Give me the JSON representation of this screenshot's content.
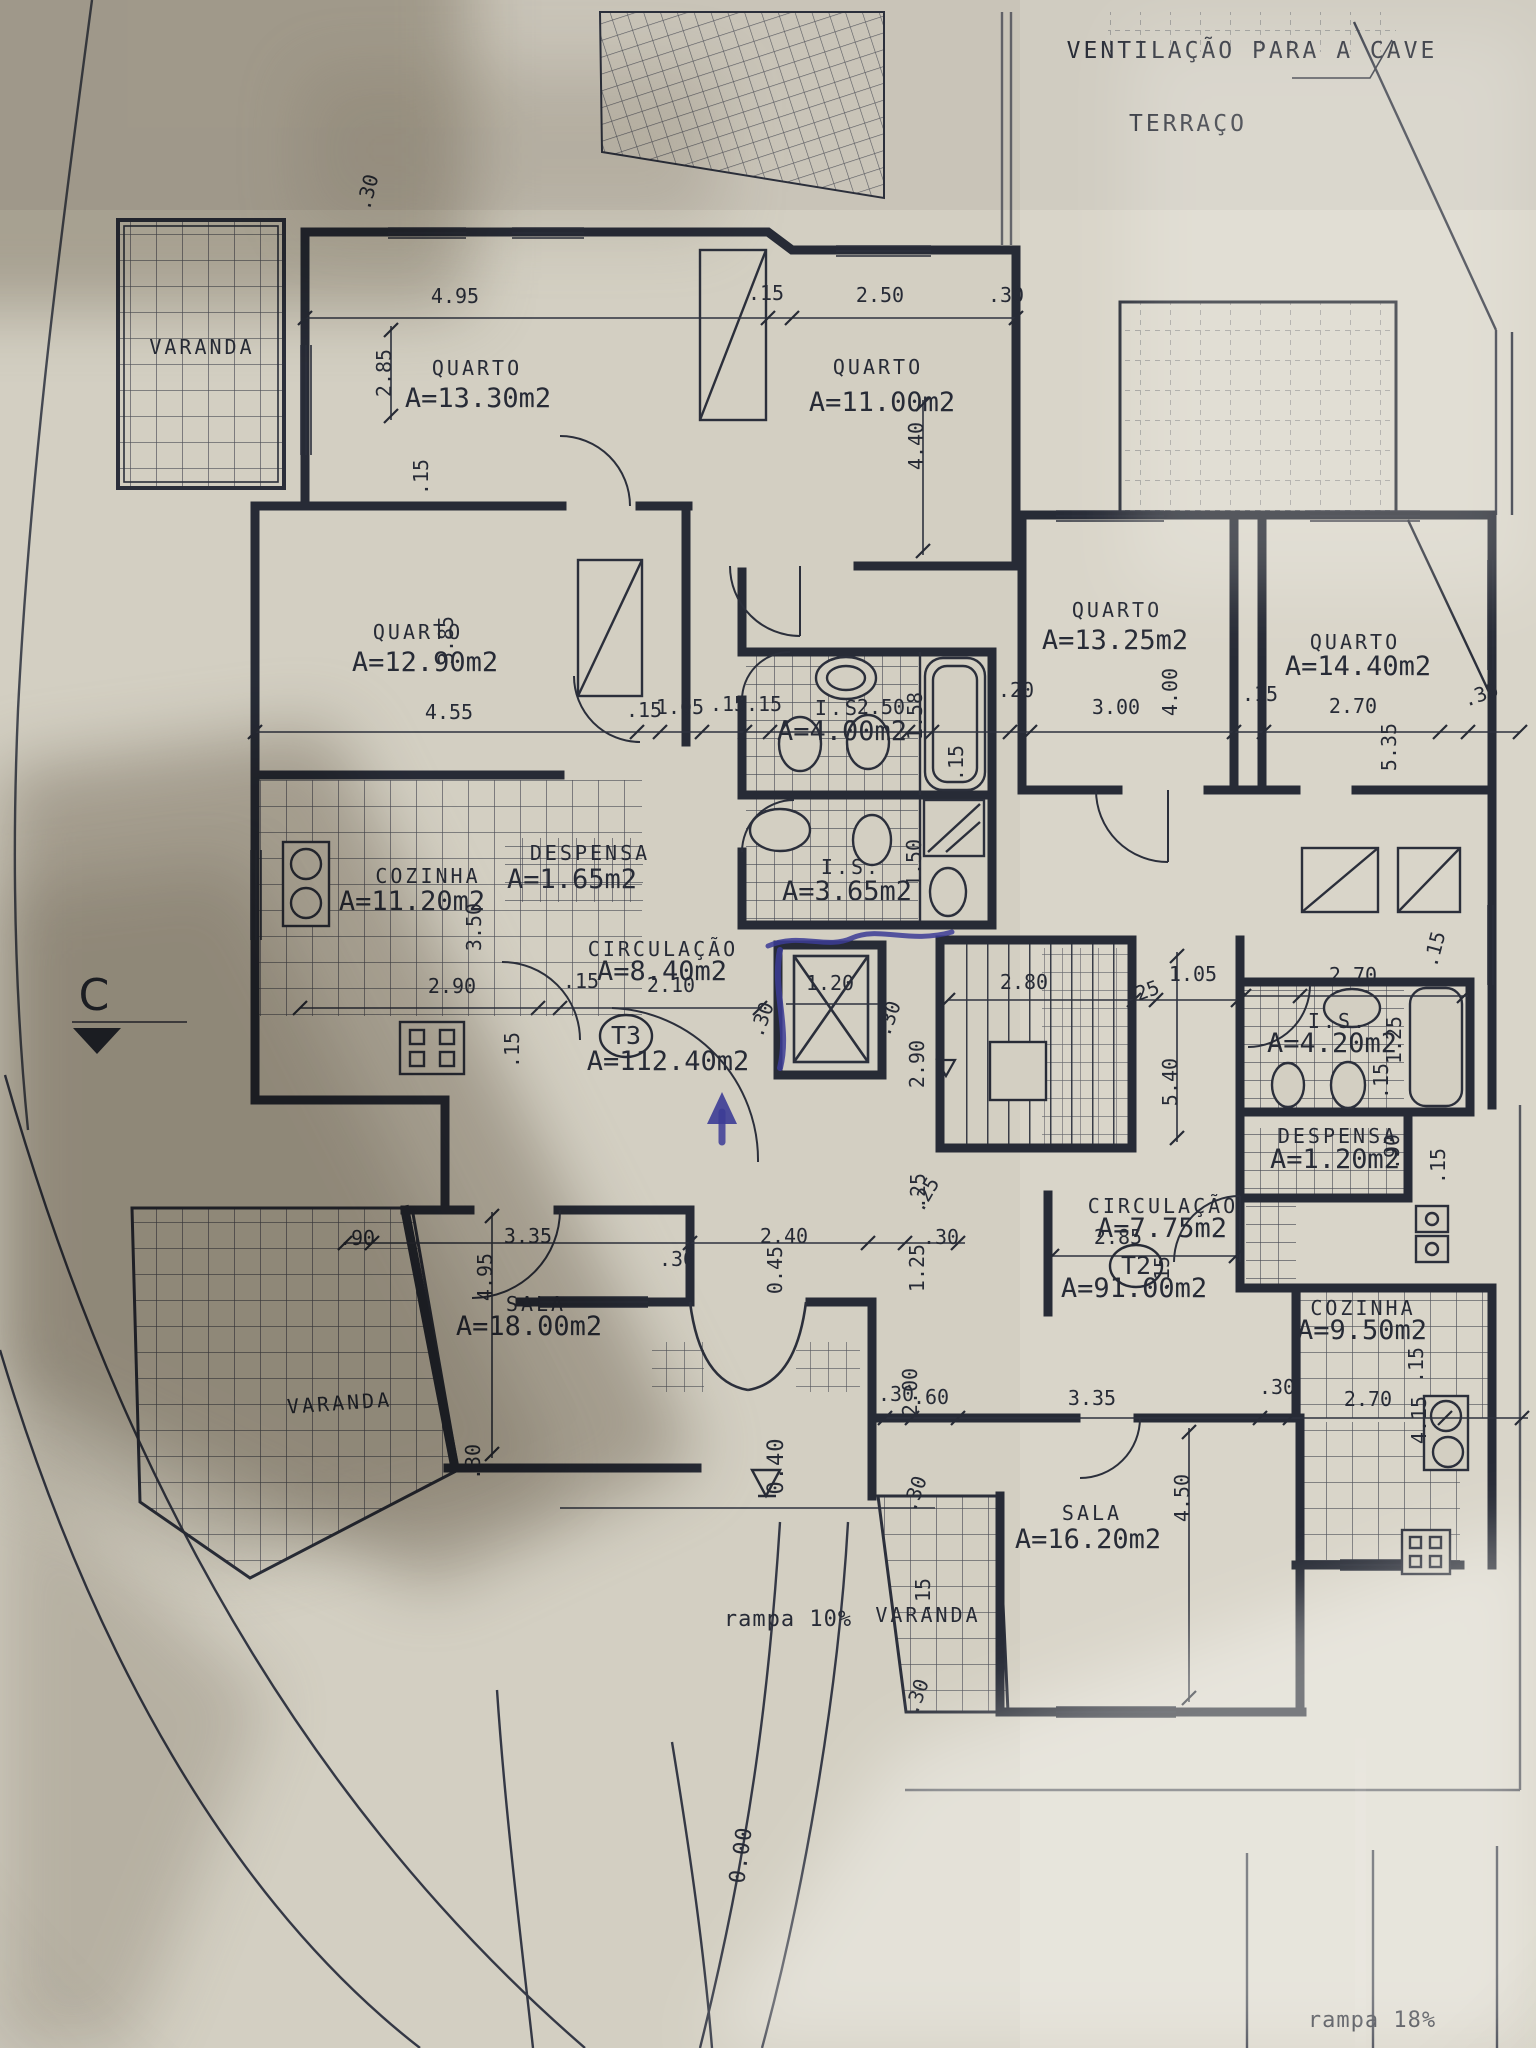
{
  "document": {
    "kind": "architectural floor plan (photographed blueprint)",
    "language": "pt"
  },
  "colors": {
    "ink": "#272b36",
    "paper": "#d3cfc2",
    "pen_blue": "#3c3c96"
  },
  "plan": {
    "notes": [
      {
        "t": "VENTILAÇÃO PARA A CAVE",
        "x": 1252,
        "y": 58,
        "cls": "t-note-lg",
        "name": "note-ventilacao-para-a-cave"
      },
      {
        "t": "TERRAÇO",
        "x": 1188,
        "y": 131,
        "cls": "t-note-lg",
        "name": "note-terraco"
      },
      {
        "t": "rampa 10%",
        "x": 788,
        "y": 1626,
        "cls": "t-note",
        "name": "note-rampa-10"
      },
      {
        "t": "rampa 18%",
        "x": 1372,
        "y": 2027,
        "cls": "t-note",
        "name": "note-rampa-18"
      },
      {
        "t": "0.00",
        "x": 748,
        "y": 1856,
        "r": -82,
        "cls": "t-note",
        "name": "level-0-00"
      },
      {
        "t": "0.40",
        "x": 783,
        "y": 1466,
        "r": -90,
        "cls": "t-note",
        "name": "level-0-40"
      },
      {
        "t": "C",
        "x": 94,
        "y": 1010,
        "cls": "t-section",
        "name": "section-marker-c"
      }
    ],
    "units": [
      {
        "label": "T3",
        "x": 626,
        "y": 1044,
        "area": "A=112.40m2",
        "ax": 668,
        "ay": 1070
      },
      {
        "label": "T2",
        "x": 1136,
        "y": 1274,
        "area": "A=91.00m2",
        "ax": 1134,
        "ay": 1297
      }
    ],
    "rooms": [
      {
        "name": "VARANDA",
        "x": 202,
        "y": 354
      },
      {
        "name": "QUARTO",
        "area": "A=13.30m2",
        "x": 477,
        "y": 375,
        "ax": 478,
        "ay": 407
      },
      {
        "name": "QUARTO",
        "area": "A=11.00m2",
        "x": 878,
        "y": 374,
        "ax": 882,
        "ay": 411
      },
      {
        "name": "QUARTO",
        "area": "A=12.90m2",
        "x": 418,
        "y": 639,
        "ax": 425,
        "ay": 671
      },
      {
        "name": "QUARTO",
        "area": "A=13.25m2",
        "x": 1117,
        "y": 617,
        "ax": 1115,
        "ay": 649
      },
      {
        "name": "QUARTO",
        "area": "A=14.40m2",
        "x": 1355,
        "y": 649,
        "ax": 1358,
        "ay": 675
      },
      {
        "name": "I.S.",
        "area": "A=4.00m2",
        "x": 845,
        "y": 715,
        "ax": 842,
        "ay": 740
      },
      {
        "name": "I.S.",
        "area": "A=3.65m2",
        "x": 851,
        "y": 874,
        "ax": 847,
        "ay": 900
      },
      {
        "name": "COZINHA",
        "area": "A=11.20m2",
        "x": 428,
        "y": 883,
        "ax": 412,
        "ay": 910
      },
      {
        "name": "DESPENSA",
        "area": "A=1.65m2",
        "x": 590,
        "y": 860,
        "ax": 572,
        "ay": 888
      },
      {
        "name": "CIRCULAÇÃO",
        "area": "A=8.40m2",
        "x": 663,
        "y": 956,
        "ax": 662,
        "ay": 980
      },
      {
        "name": "I.S.",
        "area": "A=4.20m2",
        "x": 1338,
        "y": 1028,
        "ax": 1332,
        "ay": 1052
      },
      {
        "name": "DESPENSA",
        "area": "A=1.20m2",
        "x": 1338,
        "y": 1143,
        "ax": 1335,
        "ay": 1168
      },
      {
        "name": "CIRCULAÇÃO",
        "area": "A=7.75m2",
        "x": 1163,
        "y": 1213,
        "ax": 1162,
        "ay": 1237
      },
      {
        "name": "COZINHA",
        "area": "A=9.50m2",
        "x": 1363,
        "y": 1315,
        "ax": 1362,
        "ay": 1339
      },
      {
        "name": "SALA",
        "area": "A=18.00m2",
        "x": 536,
        "y": 1311,
        "ax": 529,
        "ay": 1335
      },
      {
        "name": "SALA",
        "area": "A=16.20m2",
        "x": 1092,
        "y": 1520,
        "ax": 1088,
        "ay": 1548
      },
      {
        "name": "VARANDA",
        "x": 340,
        "y": 1410,
        "r": -4
      },
      {
        "name": "VARANDA",
        "x": 928,
        "y": 1622
      }
    ],
    "dimensions": [
      {
        "t": ".30",
        "x": 374,
        "y": 194,
        "r": -75
      },
      {
        "t": "4.95",
        "x": 455,
        "y": 303
      },
      {
        "t": ".15",
        "x": 766,
        "y": 300
      },
      {
        "t": "2.50",
        "x": 880,
        "y": 302
      },
      {
        "t": ".30",
        "x": 1006,
        "y": 302
      },
      {
        "t": "2.85",
        "x": 391,
        "y": 373,
        "r": -90
      },
      {
        "t": "4.40",
        "x": 923,
        "y": 446,
        "r": -90
      },
      {
        "t": ".15",
        "x": 428,
        "y": 477,
        "r": -90
      },
      {
        "t": "3.85",
        "x": 453,
        "y": 640,
        "r": -90
      },
      {
        "t": "4.55",
        "x": 449,
        "y": 719
      },
      {
        "t": ".15",
        "x": 644,
        "y": 717
      },
      {
        "t": "1.05",
        "x": 680,
        "y": 714
      },
      {
        "t": ".15",
        "x": 728,
        "y": 711
      },
      {
        "t": ".15",
        "x": 764,
        "y": 711
      },
      {
        "t": "2.50",
        "x": 881,
        "y": 714
      },
      {
        "t": "1.58",
        "x": 922,
        "y": 716,
        "r": -90
      },
      {
        "t": ".20",
        "x": 1016,
        "y": 697
      },
      {
        "t": "3.00",
        "x": 1116,
        "y": 714
      },
      {
        "t": "4.00",
        "x": 1177,
        "y": 692,
        "r": -90
      },
      {
        "t": ".15",
        "x": 1260,
        "y": 701
      },
      {
        "t": "2.70",
        "x": 1353,
        "y": 713
      },
      {
        "t": "5.35",
        "x": 1396,
        "y": 747,
        "r": -90
      },
      {
        "t": ".30",
        "x": 1483,
        "y": 701,
        "r": -20
      },
      {
        "t": ".15",
        "x": 963,
        "y": 763,
        "r": -90
      },
      {
        "t": "1.50",
        "x": 921,
        "y": 863,
        "r": -90
      },
      {
        "t": "3.50",
        "x": 481,
        "y": 927,
        "r": -90
      },
      {
        "t": "2.90",
        "x": 452,
        "y": 993
      },
      {
        "t": ".15",
        "x": 581,
        "y": 988
      },
      {
        "t": ".15",
        "x": 519,
        "y": 1050,
        "r": -90
      },
      {
        "t": "2.10",
        "x": 671,
        "y": 992
      },
      {
        "t": "1.20",
        "x": 830,
        "y": 990
      },
      {
        "t": ".30",
        "x": 768,
        "y": 1022,
        "r": -70
      },
      {
        "t": ".30",
        "x": 895,
        "y": 1021,
        "r": -70
      },
      {
        "t": "2.80",
        "x": 1024,
        "y": 989
      },
      {
        "t": "2.90",
        "x": 924,
        "y": 1064,
        "r": -90
      },
      {
        "t": ".25",
        "x": 1144,
        "y": 999,
        "r": -20
      },
      {
        "t": "1.05",
        "x": 1193,
        "y": 981
      },
      {
        "t": "5.40",
        "x": 1177,
        "y": 1082,
        "r": -90
      },
      {
        "t": ".15",
        "x": 1441,
        "y": 951,
        "r": -75
      },
      {
        "t": "2.70",
        "x": 1353,
        "y": 982
      },
      {
        "t": "1.25",
        "x": 1401,
        "y": 1040,
        "r": -90
      },
      {
        "t": ".15",
        "x": 1388,
        "y": 1081,
        "r": -90
      },
      {
        "t": ".90",
        "x": 1399,
        "y": 1152,
        "r": -90
      },
      {
        "t": ".15",
        "x": 1445,
        "y": 1166,
        "r": -90
      },
      {
        "t": ".25",
        "x": 925,
        "y": 1191,
        "r": -90
      },
      {
        "t": "2.85",
        "x": 1118,
        "y": 1244
      },
      {
        "t": ".15",
        "x": 1169,
        "y": 1274,
        "r": -90
      },
      {
        "t": ".90",
        "x": 357,
        "y": 1245
      },
      {
        "t": "3.35",
        "x": 528,
        "y": 1243
      },
      {
        "t": "4.95",
        "x": 492,
        "y": 1277,
        "r": -90
      },
      {
        "t": ".30",
        "x": 677,
        "y": 1266
      },
      {
        "t": "2.40",
        "x": 784,
        "y": 1243
      },
      {
        "t": "0.45",
        "x": 782,
        "y": 1270,
        "r": -90
      },
      {
        "t": ".30",
        "x": 941,
        "y": 1244
      },
      {
        "t": "1.25",
        "x": 924,
        "y": 1268,
        "r": -90
      },
      {
        "t": ".25",
        "x": 931,
        "y": 1198,
        "r": -60
      },
      {
        "t": ".30",
        "x": 480,
        "y": 1462,
        "r": -90
      },
      {
        "t": ".30",
        "x": 896,
        "y": 1401
      },
      {
        "t": ".60",
        "x": 931,
        "y": 1404
      },
      {
        "t": "2.00",
        "x": 917,
        "y": 1392,
        "r": -90
      },
      {
        "t": "3.35",
        "x": 1092,
        "y": 1405
      },
      {
        "t": ".30",
        "x": 1277,
        "y": 1394
      },
      {
        "t": "2.70",
        "x": 1368,
        "y": 1406
      },
      {
        "t": "4.50",
        "x": 1189,
        "y": 1498,
        "r": -90
      },
      {
        "t": "4.15",
        "x": 1426,
        "y": 1420,
        "r": -90
      },
      {
        "t": ".15",
        "x": 1423,
        "y": 1365,
        "r": -90
      },
      {
        "t": ".15",
        "x": 930,
        "y": 1596,
        "r": -90
      },
      {
        "t": ".30",
        "x": 921,
        "y": 1496,
        "r": -70
      },
      {
        "t": ".30",
        "x": 923,
        "y": 1699,
        "r": -70
      }
    ]
  }
}
